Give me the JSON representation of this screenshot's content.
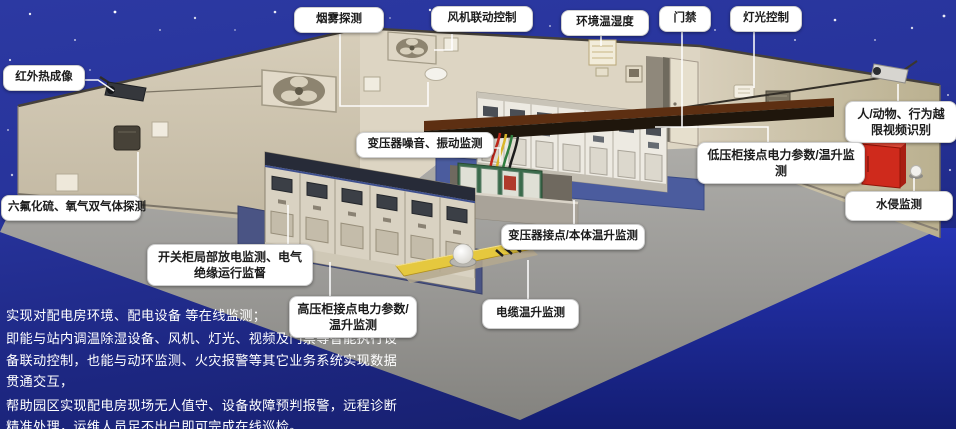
{
  "labels": {
    "smoke_detection": "烟雾探测",
    "fan_linkage_control": "风机联动控制",
    "env_temp_humidity": "环境温湿度",
    "door_access": "门禁",
    "light_control": "灯光控制",
    "infrared_thermal": "红外热成像",
    "gas_detection": "六氟化硫、氧气双气体探测",
    "person_animal_recognition": "人/动物、行为越限视频识别",
    "water_intrusion": "水侵监测",
    "transformer_noise_vibration": "变压器噪音、振动监测",
    "lv_cabinet_monitoring": "低压柜接点电力参数/温升监测",
    "transformer_contact_temp": "变压器接点/本体温升监测",
    "switchgear_partial_discharge": "开关柜局部放电监测、电气绝缘运行监督",
    "hv_cabinet_monitoring": "高压柜接点电力参数/温升监测",
    "cable_temp_rise": "电缆温升监测"
  },
  "description": {
    "line1": "实现对配电房环境、配电设备 等在线监测；",
    "line2": "即能与站内调温除湿设备、风机、灯光、视频及门禁等智能执行设备联动控制，也能与动环监测、火灾报警等其它业务系统实现数据贯通交互，",
    "line3": "帮助园区实现配电房现场无人值守、设备故障预判报警，远程诊断精准处理，运维人员足不出户即可完成在线巡检。"
  },
  "colors": {
    "sky_blue": "#2b38a1",
    "label_bg": "#ffffff",
    "label_text": "#1c1c1c",
    "wall_beige": "#cdc3ae",
    "floor_gray": "#9c9a97",
    "platform_blue": "#47589f",
    "cable_cover_yellow": "#e2c440",
    "fire_cabinet_red": "#cd2a1e",
    "transformer_green": "#3c6d4e",
    "info_text": "#ffffff"
  }
}
